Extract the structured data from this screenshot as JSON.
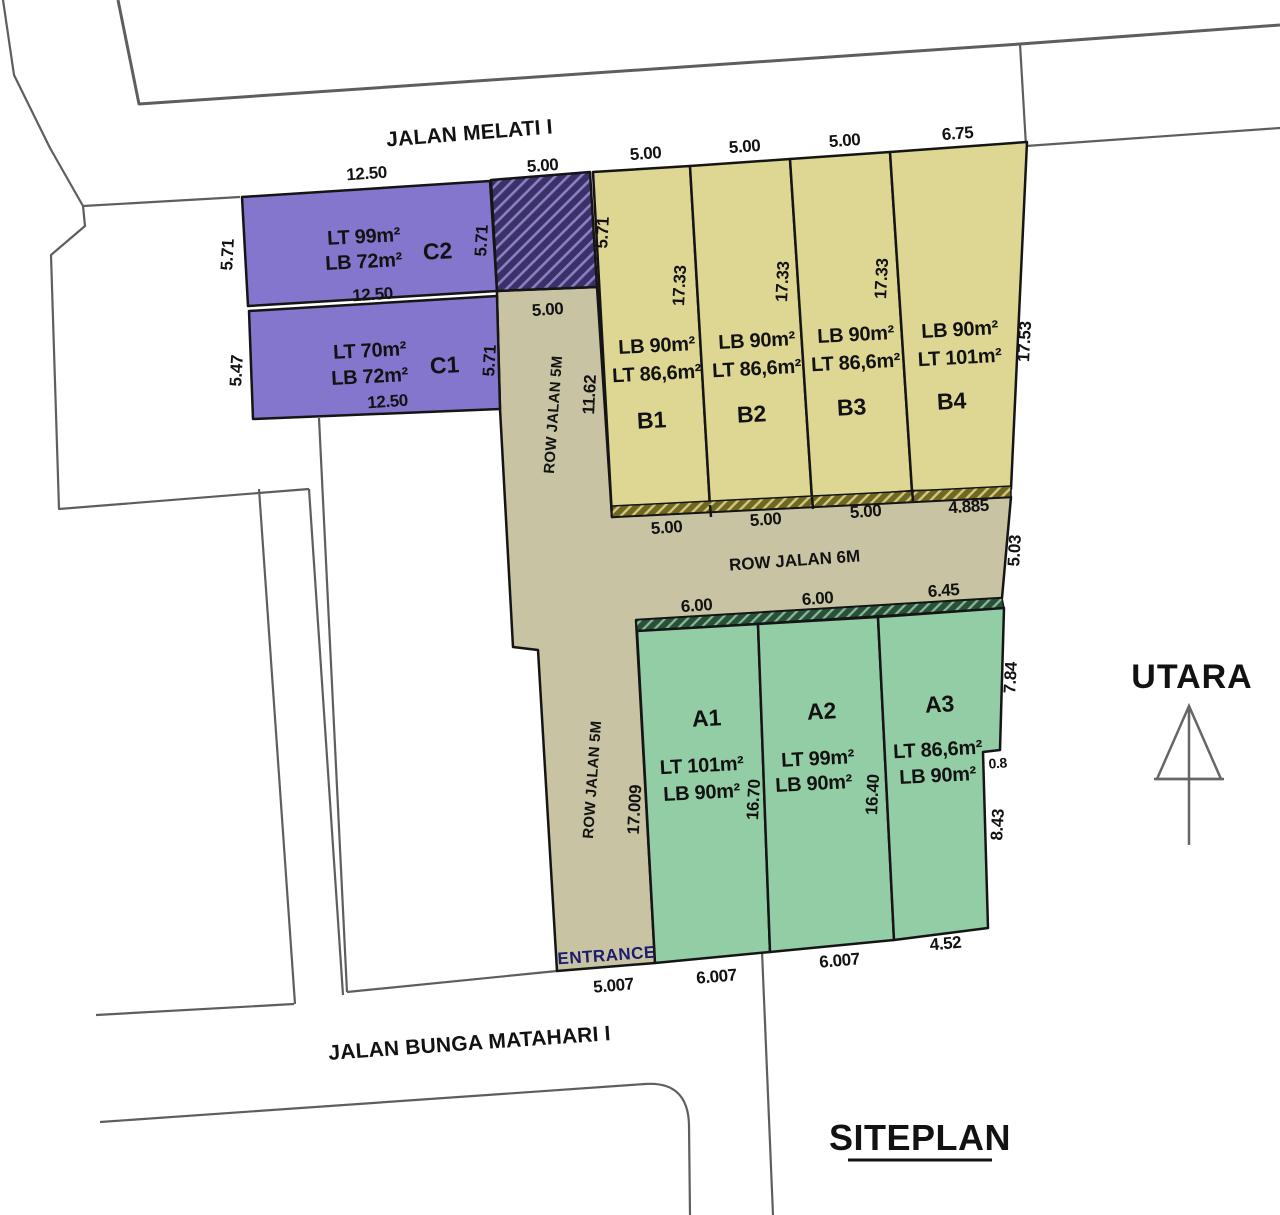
{
  "title": "SITEPLAN",
  "compass": {
    "label": "UTARA"
  },
  "roads": {
    "top": "JALAN MELATI I",
    "bottom": "JALAN BUNGA MATAHARI I",
    "row_5m_upper": "ROW JALAN 5M",
    "row_5m_lower": "ROW JALAN 5M",
    "row_6m": "ROW JALAN 6M",
    "entrance": "ENTRANCE"
  },
  "plots": {
    "c2": {
      "id": "C2",
      "line1": "LT 99m²",
      "line2": "LB 72m²"
    },
    "c1": {
      "id": "C1",
      "line1": "LT 70m²",
      "line2": "LB 72m²"
    },
    "b1": {
      "id": "B1",
      "line1": "LB 90m²",
      "line2": "LT 86,6m²"
    },
    "b2": {
      "id": "B2",
      "line1": "LB 90m²",
      "line2": "LT 86,6m²"
    },
    "b3": {
      "id": "B3",
      "line1": "LB 90m²",
      "line2": "LT 86,6m²"
    },
    "b4": {
      "id": "B4",
      "line1": "LB 90m²",
      "line2": "LT 101m²"
    },
    "a1": {
      "id": "A1",
      "line1": "LT 101m²",
      "line2": "LB 90m²"
    },
    "a2": {
      "id": "A2",
      "line1": "LT 99m²",
      "line2": "LB 90m²"
    },
    "a3": {
      "id": "A3",
      "line1": "LT 86,6m²",
      "line2": "LB 90m²"
    }
  },
  "dims": {
    "c2_top": "12.50",
    "c2_bottom": "12.50",
    "c1_bottom": "12.50",
    "c2_left": "5.71",
    "c1_left": "5.47",
    "c2_right": "5.71",
    "c1_right": "5.71",
    "gate_top": "5.00",
    "row5_width": "5.00",
    "row5_upper_len": "11.62",
    "b1_left": "5.71",
    "b1_top": "5.00",
    "b2_top": "5.00",
    "b3_top": "5.00",
    "b4_top": "6.75",
    "b1_len": "17.33",
    "b2_len": "17.33",
    "b3_len": "17.33",
    "b4_right": "17.53",
    "b1_bottom": "5.00",
    "b2_bottom": "5.00",
    "b3_bottom": "5.00",
    "b4_bottom": "4.885",
    "row6_right": "5.03",
    "a1_top": "6.00",
    "a2_top": "6.00",
    "a3_top": "6.45",
    "a3_right_upper": "7.84",
    "a3_step": "0.8",
    "a3_right_lower": "8.43",
    "a1_a2_len": "16.70",
    "a2_a3_len": "16.40",
    "a1_left": "17.009",
    "a1_bottom": "6.007",
    "a2_bottom": "6.007",
    "a3_bottom": "4.52",
    "entrance_width": "5.007"
  },
  "colors": {
    "plot_purple": "#8376cc",
    "plot_yellow": "#ded794",
    "plot_green": "#93cda6",
    "road_olive": "#c8c4a3",
    "hatch_purple_bg": "#3b3168",
    "hatch_olive_bg": "#6f6724",
    "hatch_green_bg": "#2c4f3a",
    "boundary_gray": "#5e5e5e",
    "entrance_text": "#1b1b70"
  }
}
